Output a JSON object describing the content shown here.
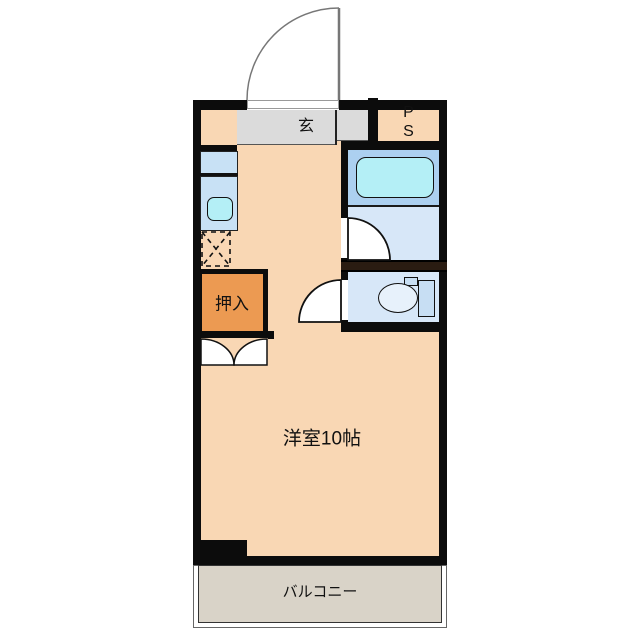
{
  "floorplan": {
    "rooms": {
      "entrance": {
        "label": "玄"
      },
      "pipe_space": {
        "line1": "P",
        "line2": "S"
      },
      "closet": {
        "label": "押入"
      },
      "main_room": {
        "label": "洋室10帖"
      },
      "balcony": {
        "label": "バルコニー"
      }
    },
    "fixtures": [
      "entrance-door-icon",
      "bathtub-icon",
      "kitchen-sink-icon",
      "toilet-icon",
      "closet-double-door-icon",
      "appliance-space-icon"
    ],
    "colors": {
      "wall_color": "#0c0c0c",
      "dark_wall_color": "#2a1c12",
      "room_fill": "#f9d7b4",
      "closet_fill": "#ec9a52",
      "entrance_fill": "#dbdbdb",
      "balcony_fill": "#d9d3c8",
      "bath_upper_fill": "#acd0f0",
      "bath_lower_fill": "#d7e7f8",
      "kitchen_fill": "#c8e1f5",
      "fixture_fill": "#b4eff6",
      "tank_fill": "#c7def3",
      "bowl_fill": "#e7f1fb"
    }
  }
}
